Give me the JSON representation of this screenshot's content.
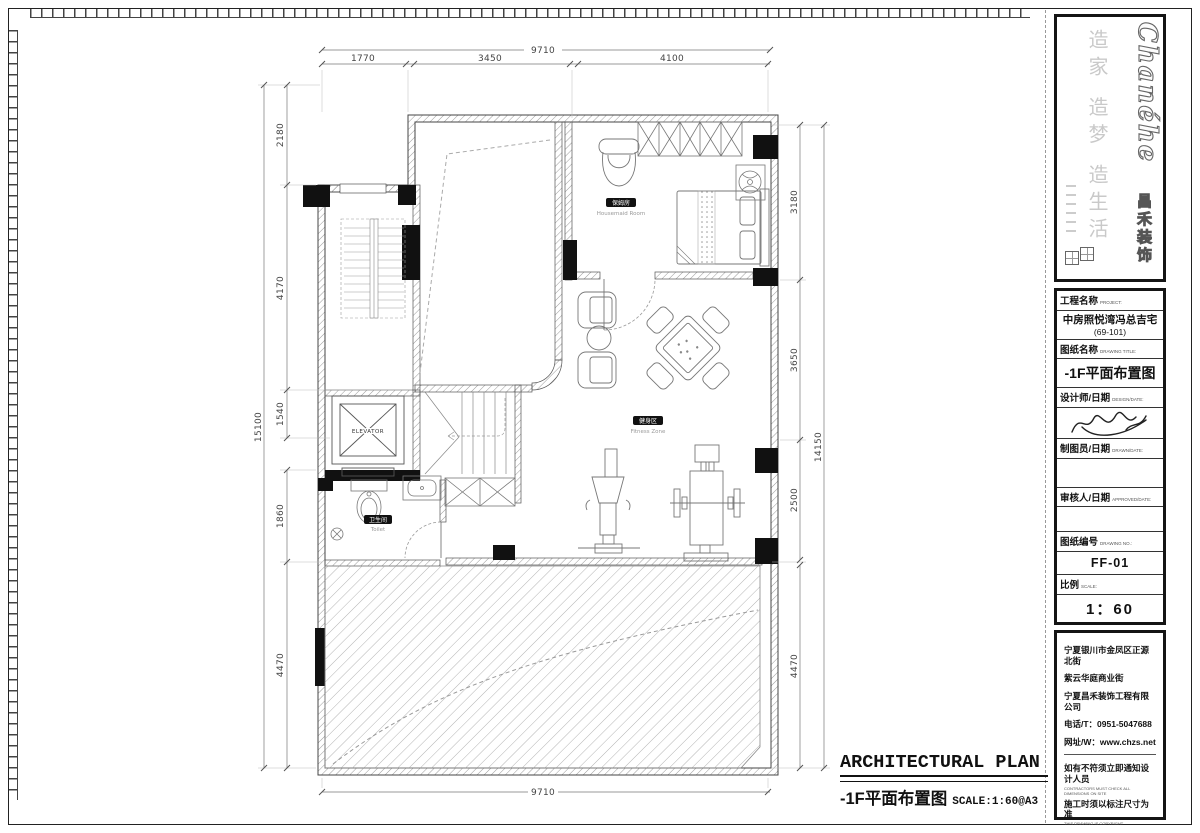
{
  "logo": {
    "brand": "Chanéhe",
    "company_cn": "昌禾装饰",
    "tagline": "造家 造梦 造生活"
  },
  "title_block": {
    "project_label": "工程名称",
    "project_label_en": "PROJECT:",
    "project_name": "中房照悦湾冯总吉宅",
    "project_unit": "(69-101)",
    "drawing_title_label": "图纸名称",
    "drawing_title_label_en": "DRAWING TITLE:",
    "drawing_title": "-1F平面布置图",
    "designer_label": "设计师/日期",
    "designer_label_en": "DESIGN/DATE:",
    "drafter_label": "制图员/日期",
    "drafter_label_en": "DRAWN/DATE:",
    "approver_label": "审核人/日期",
    "approver_label_en": "APPROVED/DATE:",
    "drawing_no_label": "图纸编号",
    "drawing_no_label_en": "DRAWING NO.:",
    "drawing_no": "FF-01",
    "scale_label": "比例",
    "scale_label_en": "SCALE:",
    "scale_value": "1：60"
  },
  "footer": {
    "address_line1": "宁夏银川市金凤区正源北街",
    "address_line2": "紫云华庭商业街",
    "company": "宁夏昌禾装饰工程有限公司",
    "phone": "电话/T：0951-5047688",
    "website": "网址/W：www.chzs.net",
    "note1_cn": "如有不符须立即通知设计人员",
    "note1_en": "CONTRACTORS MUST CHECK ALL DIMENSIONS ON SITE",
    "note2_cn": "施工时须以标注尺寸为准",
    "note2_en": "THIS DRAWING IS COPYRIGHT"
  },
  "plan_caption": {
    "title_en": "ARCHITECTURAL PLAN",
    "title_cn": "-1F平面布置图",
    "scale_note": "SCALE:1:60@A3"
  },
  "rooms": {
    "housemaid_cn": "保姆房",
    "housemaid_en": "Housemaid Room",
    "fitness_cn": "健身区",
    "fitness_en": "Fitness Zone",
    "toilet_cn": "卫生间",
    "toilet_en": "Toilet",
    "elevator": "ELEVATOR"
  },
  "dims": {
    "top_total": "9710",
    "top_seg1": "1770",
    "top_seg2": "3450",
    "top_seg3": "4100",
    "bottom_total": "9710",
    "left_total": "15100",
    "left_seg1": "2180",
    "left_seg2": "4170",
    "left_seg3": "1540",
    "left_seg4": "1860",
    "left_seg5": "4470",
    "right_total": "14150",
    "right_seg1": "3180",
    "right_seg2": "3650",
    "right_seg3": "2500",
    "right_seg4": "4470"
  },
  "colors": {
    "line": "#444444",
    "column_fill": "#111111",
    "hatch": "#9a9a9a"
  }
}
